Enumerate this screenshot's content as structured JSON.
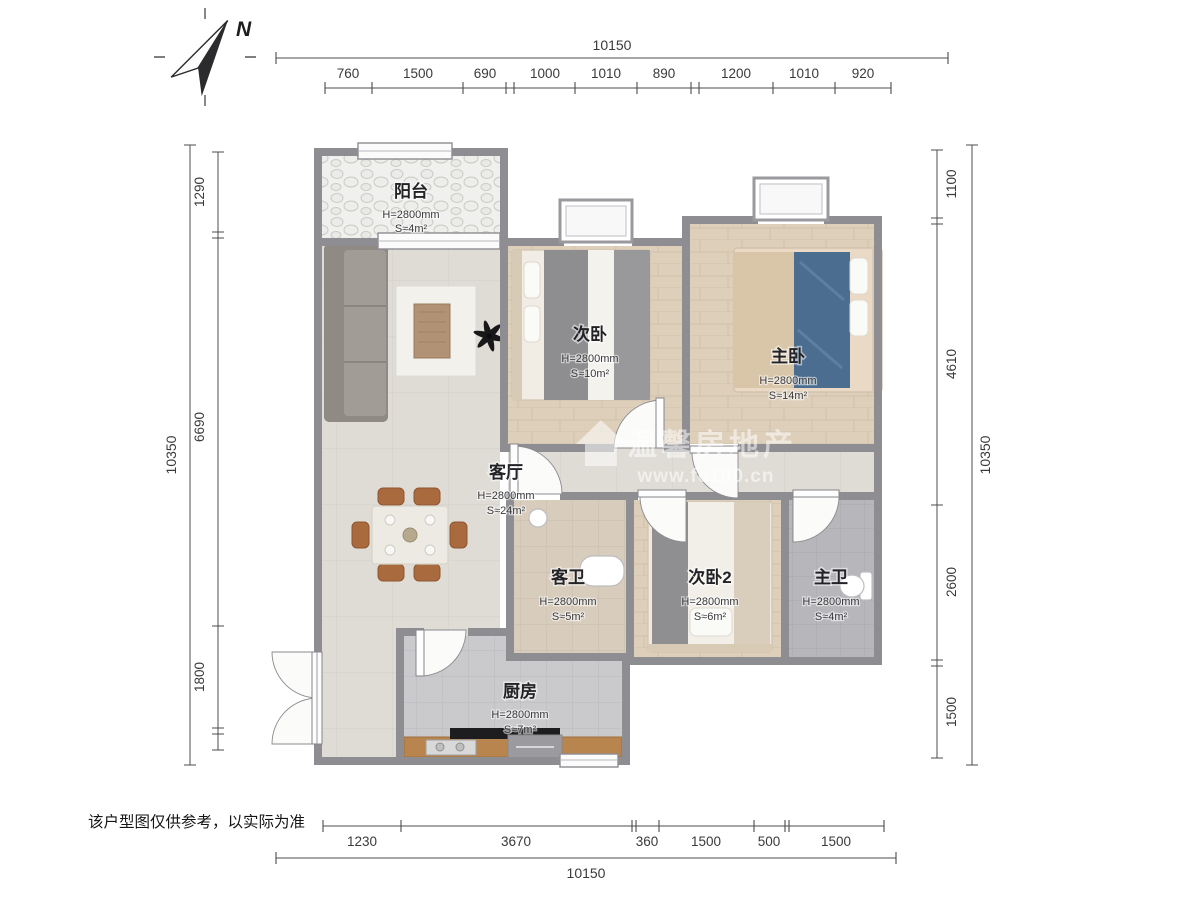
{
  "compass": {
    "label": "N"
  },
  "disclaimer": "该户型图仅供参考，以实际为准",
  "watermark": {
    "brand": "温馨房地产",
    "url": "www.fc100.cn"
  },
  "rooms": [
    {
      "id": "balcony",
      "name": "阳台",
      "height": "H=2800mm",
      "area": "S≈4m²"
    },
    {
      "id": "bedroom-2",
      "name": "次卧",
      "height": "H=2800mm",
      "area": "S≈10m²"
    },
    {
      "id": "master-bedroom",
      "name": "主卧",
      "height": "H=2800mm",
      "area": "S≈14m²"
    },
    {
      "id": "living-room",
      "name": "客厅",
      "height": "H=2800mm",
      "area": "S≈24m²"
    },
    {
      "id": "guest-bathroom",
      "name": "客卫",
      "height": "H=2800mm",
      "area": "S≈5m²"
    },
    {
      "id": "bedroom-3",
      "name": "次卧2",
      "height": "H=2800mm",
      "area": "S≈6m²"
    },
    {
      "id": "master-bathroom",
      "name": "主卫",
      "height": "H=2800mm",
      "area": "S≈4m²"
    },
    {
      "id": "kitchen",
      "name": "厨房",
      "height": "H=2800mm",
      "area": "S≈7m²"
    }
  ],
  "dimensions": {
    "top": {
      "total": "10150",
      "segments": [
        "760",
        "1500",
        "690",
        "1000",
        "1010",
        "890",
        "1200",
        "1010",
        "920"
      ]
    },
    "bottom": {
      "total": "10150",
      "segments": [
        "1230",
        "3670",
        "360",
        "1500",
        "500",
        "1500"
      ]
    },
    "left": {
      "total": "10350",
      "segments": [
        "1290",
        "6690",
        "1800"
      ]
    },
    "right": {
      "total": "10350",
      "segments": [
        "1100",
        "4610",
        "2600",
        "1500"
      ]
    }
  },
  "colors": {
    "wall": "#8d8d92",
    "wood_floor": "#ddcfba",
    "living_floor": "#dfdcd6",
    "bath_tile": "#d8ccbd",
    "gray_tile": "#b7b7bb",
    "kitchen_tile": "#cacacd",
    "accent_blue": "#4b6d8f",
    "counter_wood": "#b9854e"
  }
}
